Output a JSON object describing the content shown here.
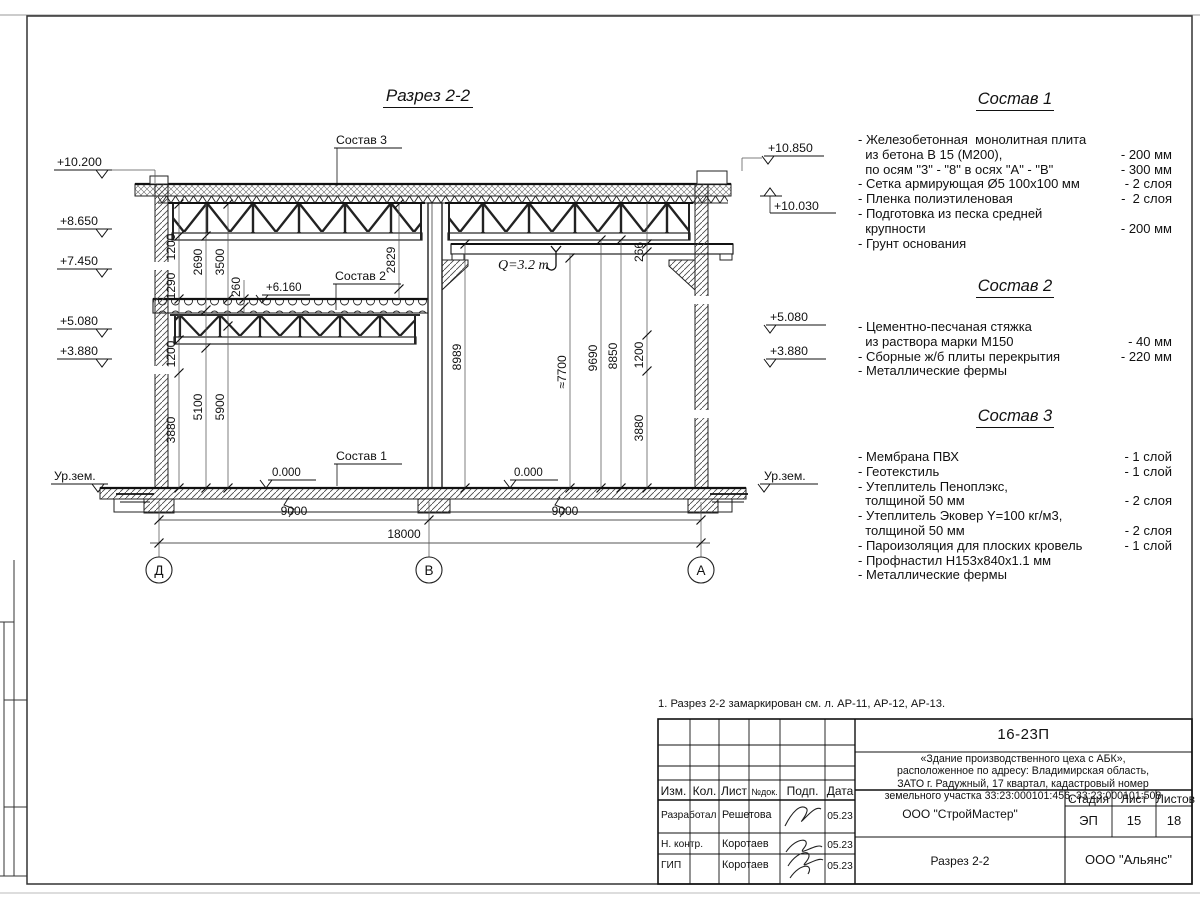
{
  "sheet": {
    "title": "Разрез 2-2",
    "note": "1. Разрез 2-2 замаркирован см. л. АР-11, АР-12, АР-13."
  },
  "drawing": {
    "labels": {
      "sostav1": "Состав 1",
      "sostav2": "Состав 2",
      "sostav3": "Состав 3",
      "crane": "Q=3.2 т",
      "level_mezz": "+6.160",
      "zero_left": "0.000",
      "zero_right": "0.000"
    },
    "elev_left": {
      "e1": "+10.200",
      "e2": "+8.650",
      "e3": "+7.450",
      "e4": "+5.080",
      "e5": "+3.880",
      "ground": "Ур.зем."
    },
    "elev_right": {
      "e1": "+10.850",
      "e2": "+10.030",
      "e3": "+5.080",
      "e4": "+3.880",
      "ground": "Ур.зем."
    },
    "dims": {
      "lt1": "1200",
      "lt2": "2690",
      "lt3": "3500",
      "lt4": "1290",
      "lt5": "260",
      "lt6": "2829",
      "lb1": "1200",
      "lb2": "3880",
      "lb3": "5100",
      "lb4": "5900",
      "r1": "8989",
      "r2": "≈7700",
      "r3": "9690",
      "r4": "8850",
      "r5": "1200",
      "r6": "266",
      "r7": "3880",
      "b1": "9000",
      "b2": "9000",
      "b3": "18000"
    },
    "axes": {
      "a1": "Д",
      "a2": "В",
      "a3": "А"
    }
  },
  "sostav1": {
    "title": "Состав 1",
    "items": [
      {
        "t": "- Железобетонная  монолитная плита",
        "v": ""
      },
      {
        "t": "  из бетона В 15 (М200),",
        "v": "- 200 мм"
      },
      {
        "t": "  по осям \"3\" - \"8\" в осях \"А\" - \"В\"",
        "v": "- 300 мм"
      },
      {
        "t": "- Сетка армирующая Ø5 100х100 мм",
        "v": "- 2 слоя"
      },
      {
        "t": "- Пленка полиэтиленовая",
        "v": "-  2 слоя"
      },
      {
        "t": "- Подготовка из песка средней",
        "v": ""
      },
      {
        "t": "  крупности",
        "v": "- 200 мм"
      },
      {
        "t": "- Грунт основания",
        "v": ""
      }
    ]
  },
  "sostav2": {
    "title": "Состав 2",
    "items": [
      {
        "t": "- Цементно-песчаная стяжка",
        "v": ""
      },
      {
        "t": "  из раствора марки М150",
        "v": "- 40 мм"
      },
      {
        "t": "- Сборные ж/б плиты перекрытия",
        "v": "- 220 мм"
      },
      {
        "t": "- Металлические фермы",
        "v": ""
      }
    ]
  },
  "sostav3": {
    "title": "Состав 3",
    "items": [
      {
        "t": "- Мембрана ПВХ",
        "v": "- 1 слой"
      },
      {
        "t": "- Геотекстиль",
        "v": "- 1 слой"
      },
      {
        "t": "- Утеплитель Пеноплэкс,",
        "v": ""
      },
      {
        "t": "  толщиной 50 мм",
        "v": "- 2 слоя"
      },
      {
        "t": "- Утеплитель Эковер Y=100 кг/м3,",
        "v": ""
      },
      {
        "t": "  толщиной 50 мм",
        "v": "- 2 слоя"
      },
      {
        "t": "- Пароизоляция для плоских кровель",
        "v": "- 1 слой"
      },
      {
        "t": "- Профнастил Н153х840х1.1 мм",
        "v": ""
      },
      {
        "t": "- Металлические фермы",
        "v": ""
      }
    ]
  },
  "titleblock": {
    "doc_number": "16-23П",
    "description_lines": [
      "«Здание производственного цеха с АБК»,",
      "расположенное по адресу: Владимирская область,",
      "ЗАТО г. Радужный, 17 квартал, кадастровый номер",
      "земельного участка 33:23:000101:456, 33:23:000101:508"
    ],
    "col_izm": "Изм.",
    "col_kol": "Кол.",
    "col_list": "Лист",
    "col_ndoc": "№док.",
    "col_podp": "Подп.",
    "col_data": "Дата",
    "rows": [
      {
        "role": "Разработал",
        "name": "Решетова",
        "date": "05.23"
      },
      {
        "role": "Н. контр.",
        "name": "Коротаев",
        "date": "05.23"
      },
      {
        "role": "ГИП",
        "name": "Коротаев",
        "date": "05.23"
      }
    ],
    "org_design": "ООО \"СтройМастер\"",
    "stage_label": "Стадия",
    "sheet_label": "Лист",
    "sheets_label": "Листов",
    "stage": "ЭП",
    "sheet_no": "15",
    "sheets_total": "18",
    "drawing_name": "Разрез 2-2",
    "org_customer": "ООО \"Альянс\""
  }
}
